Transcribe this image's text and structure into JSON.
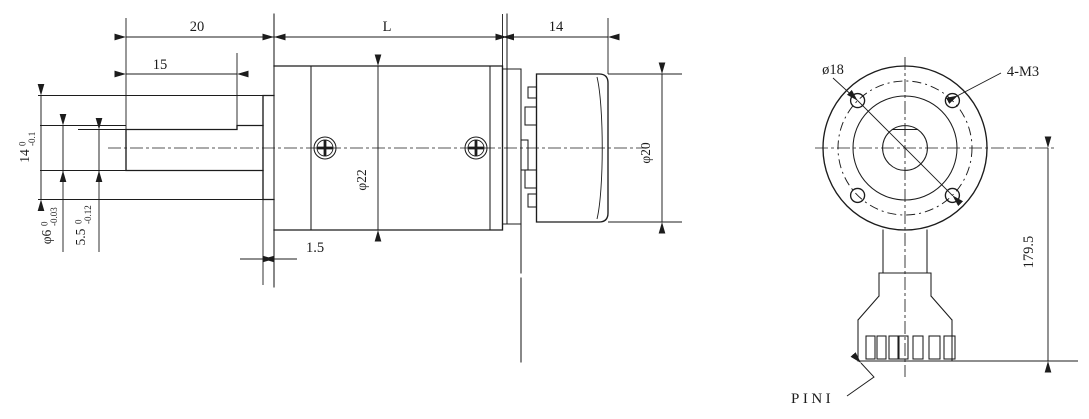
{
  "meta": {
    "background": "#ffffff",
    "line_color": "#1c1c1c",
    "drawing_type": "gear motor outline drawing, side view and front/connector view"
  },
  "side_view": {
    "labels": {
      "shaft_length": "20",
      "flat_length": "15",
      "body_length": "L",
      "motor_length": "14",
      "plate_thickness": "1.5",
      "gearbox_dia": "φ22",
      "motor_dia": "φ20",
      "boss_dia": {
        "main": "14",
        "sup": "0",
        "sub": "-0.1"
      },
      "shaft_dia": {
        "main": "φ6",
        "sup": "0",
        "sub": "-0.03"
      },
      "shaft_flat": {
        "main": "5.5",
        "sup": "0",
        "sub": "-0.12"
      }
    }
  },
  "front_view": {
    "labels": {
      "bolt_circle_dia": "ø18",
      "mounting_holes": "4-M3",
      "lead_length": "179.5",
      "pin_label": "PINI"
    }
  }
}
